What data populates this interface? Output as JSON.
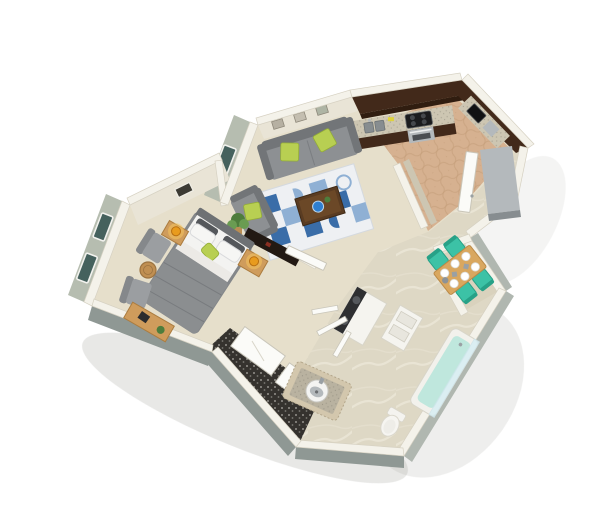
{
  "scene": {
    "title": "3D isometric floor plan of a one-bedroom apartment",
    "width": 600,
    "height": 529
  },
  "palette": {
    "bg": "#ffffff",
    "wallTop": "#f4f2ea",
    "wallFace": "#e9e4d6",
    "wallShadow": "#d6d1c2",
    "extWallSage": "#b6bdb0",
    "extWallGray": "#8f9894",
    "extWallGrayLight": "#b0b7b0",
    "windowGlass": "#45615d",
    "carpet": "#e6dfcb",
    "carpetShade": "#d9d2bd",
    "tileKitchen": "#d6b190",
    "tileGrout": "#c09a77",
    "marble": "#ded8c5",
    "marbleVein": "#ece7d8",
    "closetDark": "#35322e",
    "darkWood": "#42291a",
    "darkWood2": "#301d10",
    "counter": "#cdc6b2",
    "stainless": "#b4b9bc",
    "stainlessDark": "#878d90",
    "black": "#1b1c1e",
    "sofaGray": "#8d9093",
    "sofaGrayDark": "#727578",
    "lime": "#b8cf52",
    "limeDark": "#93ad37",
    "rugBase": "#eef0f3",
    "rugBlue": "#3a6da8",
    "rugBlueLight": "#8fb0d4",
    "woodOak": "#cf9c5c",
    "woodOakDark": "#ab7c3f",
    "tableBrown": "#5a3c22",
    "tealChair": "#3cc2a6",
    "tealChairDark": "#27a187",
    "amber": "#e89b1e",
    "amberGlow": "#f6c55e",
    "white": "#ffffff",
    "offWhite": "#f5f4ef",
    "doorWhite": "#fbfbf8",
    "bedBlanket": "#8b8e90",
    "bedSheet": "#f3f3f1",
    "pillowDark": "#54575b",
    "aquaTub": "#bfe7dd",
    "aquaGlass": "#d7eef4",
    "plantGreen": "#4e7d3c",
    "plantGreenLight": "#6a9c52"
  },
  "inventory": {
    "rooms": [
      "bedroom",
      "living-room",
      "kitchen",
      "dining-nook",
      "bathroom",
      "laundry",
      "closet",
      "hallway"
    ],
    "window_count": 4,
    "wall_frame_count": 3,
    "lamp_count": 2,
    "dining_chair_count": 4,
    "dining_plate_count": 6,
    "furniture": [
      "bed",
      "nightstands",
      "armchairs",
      "round-stool",
      "bench-desk",
      "sofa",
      "loveseat",
      "area-rug",
      "coffee-table",
      "potted-plant",
      "kitchen-counter",
      "cooktop-oven",
      "kitchen-sink",
      "microwave",
      "refrigerator",
      "dining-table",
      "teal-chairs",
      "washer-dryer",
      "linen-shelves",
      "bathtub",
      "vanity-sink",
      "toilet",
      "sliding-closet-doors",
      "media-console",
      "entry-door",
      "bedroom-door"
    ]
  }
}
